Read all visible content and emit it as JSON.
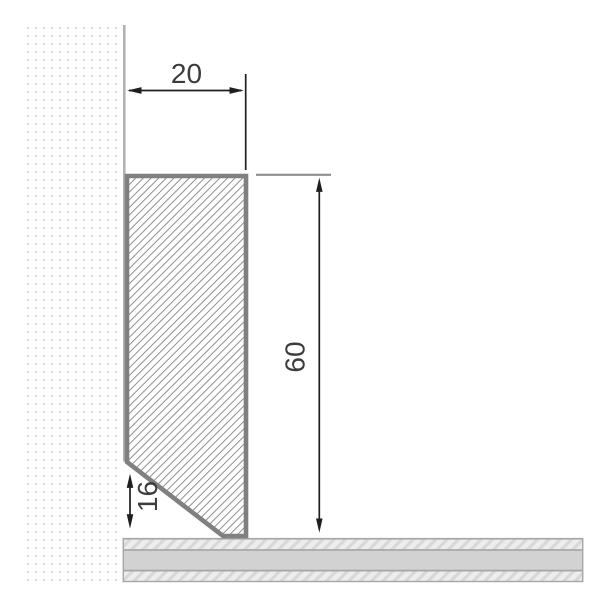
{
  "drawing": {
    "type": "technical-cross-section",
    "subject": "skirting-board-profile-on-wall-and-floor",
    "dimensions": {
      "width_label": "20",
      "height_label": "60",
      "bevel_label": "16"
    },
    "colors": {
      "background": "#ffffff",
      "profile_border": "#808080",
      "profile_hatch_line": "#8f8f8f",
      "wall_dot": "#d9d9d9",
      "wall_edge_line": "#b2b2b2",
      "floor_border": "#a6a6a6",
      "floor_solid_band": "#d2d2d2",
      "floor_hatch_bg": "#ededed",
      "floor_hatch_line": "#d8d8d8",
      "dimension_line": "#1f1f1f",
      "extension_line_gray": "#8e8e8e",
      "dimension_text": "#3c3c3c"
    }
  }
}
